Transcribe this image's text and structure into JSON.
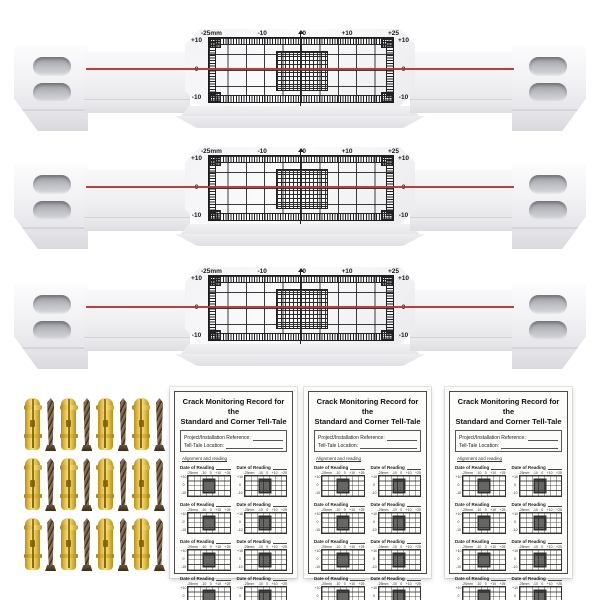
{
  "product": {
    "background_color": "#ffffff"
  },
  "gauge": {
    "name": "crack-monitoring-tell-tale-gauge",
    "count": 3,
    "scale_top": [
      "-25mm",
      "-10",
      "0",
      "+10",
      "+25"
    ],
    "scale_side": [
      "+10",
      "0",
      "-10"
    ],
    "zero_line_color": "#b5372e"
  },
  "fasteners": {
    "rows": 3,
    "pairs_per_row": 4,
    "plug_color": "#e8c84a",
    "screw_color": "#5d4a33"
  },
  "card": {
    "count": 3,
    "title_line1": "Crack Monitoring Record for the",
    "title_line2": "Standard and Corner Tell-Tale",
    "field1_label": "Project/Installation Reference:",
    "field2_label": "Tell-Tale Location:",
    "note": "Alignment and reading",
    "entries_per_card": 8,
    "entry_label": "Date of Reading",
    "mini_scale": [
      "-25mm",
      "-10",
      "0",
      "+10",
      "+25"
    ],
    "mini_side": [
      "+10",
      "0",
      "-10"
    ]
  }
}
